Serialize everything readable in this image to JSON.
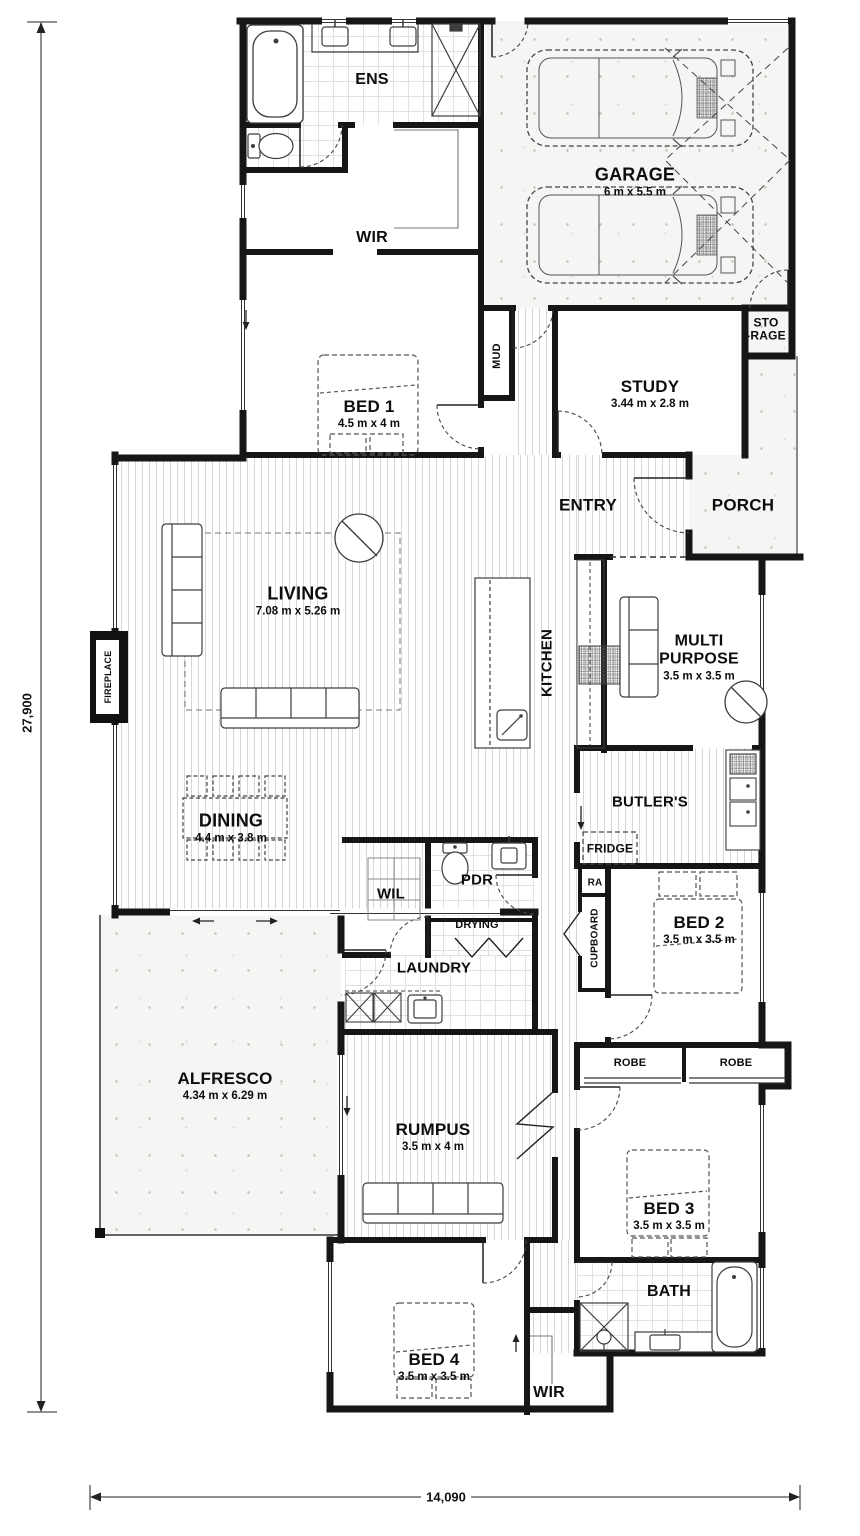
{
  "dimensions": {
    "overall_depth": "27,900",
    "overall_width": "14,090"
  },
  "rooms": {
    "ens": {
      "label": "ENS"
    },
    "wir_master": {
      "label": "WIR"
    },
    "garage": {
      "label": "GARAGE",
      "size": "6 m x 5.5 m"
    },
    "bed1": {
      "label": "BED 1",
      "size": "4.5 m x 4 m"
    },
    "mud": {
      "label": "MUD"
    },
    "study": {
      "label": "STUDY",
      "size": "3.44 m x 2.8 m"
    },
    "storage": {
      "label": "STO\n-RAGE"
    },
    "entry": {
      "label": "ENTRY"
    },
    "porch": {
      "label": "PORCH"
    },
    "living": {
      "label": "LIVING",
      "size": "7.08 m x 5.26 m"
    },
    "kitchen": {
      "label": "KITCHEN"
    },
    "fireplace": {
      "label": "FIREPLACE"
    },
    "multipurpose": {
      "label": "MULTI\nPURPOSE",
      "size": "3.5 m x 3.5 m"
    },
    "butlers": {
      "label": "BUTLER'S"
    },
    "fridge": {
      "label": "FRIDGE"
    },
    "ra": {
      "label": "RA"
    },
    "cupboard": {
      "label": "CUPBOARD"
    },
    "bed2": {
      "label": "BED 2",
      "size": "3.5 m x 3.5 m"
    },
    "dining": {
      "label": "DINING",
      "size": "4.4 m x 3.8 m"
    },
    "wil": {
      "label": "WIL"
    },
    "pdr": {
      "label": "PDR"
    },
    "drying": {
      "label": "DRYING"
    },
    "laundry": {
      "label": "LAUNDRY"
    },
    "alfresco": {
      "label": "ALFRESCO",
      "size": "4.34 m x 6.29 m"
    },
    "rumpus": {
      "label": "RUMPUS",
      "size": "3.5 m x 4 m"
    },
    "robe1": {
      "label": "ROBE"
    },
    "robe2": {
      "label": "ROBE"
    },
    "bed3": {
      "label": "BED 3",
      "size": "3.5 m x 3.5 m"
    },
    "bath": {
      "label": "BATH"
    },
    "bed4": {
      "label": "BED 4",
      "size": "3.5 m x 3.5 m"
    },
    "wir_minor": {
      "label": "WIR"
    }
  }
}
